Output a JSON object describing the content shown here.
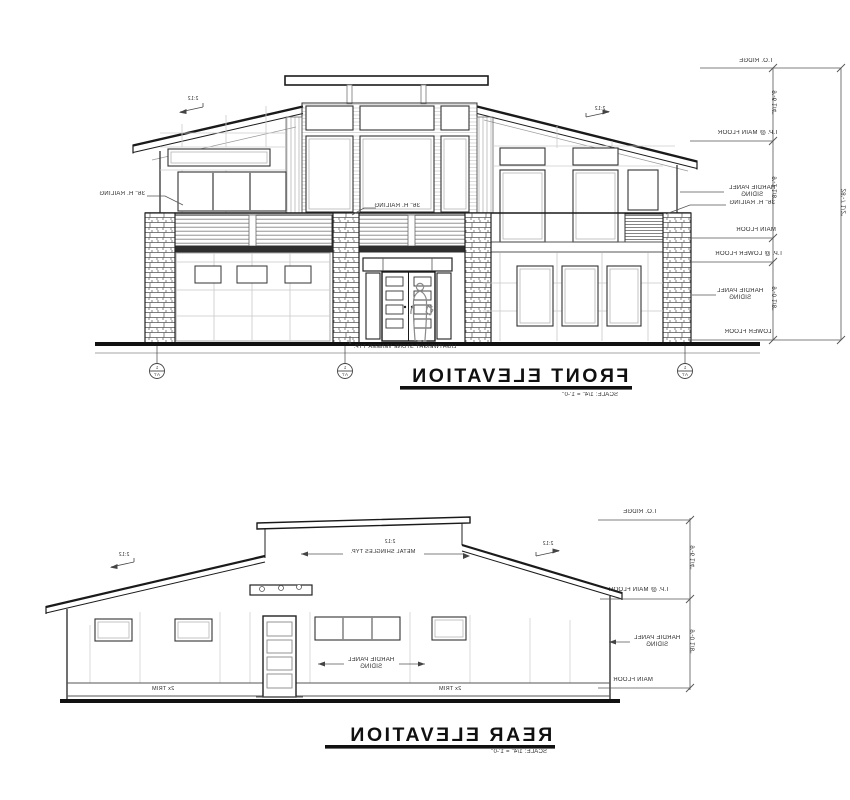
{
  "sheet": {
    "background": "#ffffff",
    "line_color": "#1a1a1a",
    "panel_gray": "#c9c9c9",
    "annotation_gray": "#555555"
  },
  "front": {
    "title": "FRONT ELEVATION",
    "scale_note": "SCALE: 1/4\" = 1'-0\"",
    "levels": {
      "ridge": "T.O. RIDGE",
      "plate_main": "T.P. @ MAIN FLOOR",
      "main": "MAIN FLOOR",
      "plate_lower": "T.P. @ LOWER FLOOR",
      "lower": "LOWER FLOOR"
    },
    "dims": {
      "ridge_to_plate": "9'-6 1/4\"",
      "plate_to_main": "9'-1 1/8\"",
      "plate_to_lower": "9'-0 1/8\"",
      "overall": "28'-7 1/2\""
    },
    "notes": {
      "hardie": "HARDIE PANEL\nSIDING",
      "railing": "36\" H. RAILING",
      "stone": "LIGHTWEIGHT STONE VENEER TYP.",
      "slope": "2:12"
    },
    "grid_bubble": {
      "top": "1",
      "bottom": "A7"
    }
  },
  "rear": {
    "title": "REAR ELEVATION",
    "scale_note": "SCALE: 1/4\" = 1'-0\"",
    "levels": {
      "ridge": "T.O. RIDGE",
      "plate_main": "T.P. @ MAIN FLOOR",
      "main": "MAIN FLOOR"
    },
    "dims": {
      "ridge_to_plate": "9'-6 1/4\"",
      "plate_to_main": "9'-0 1/8\""
    },
    "notes": {
      "shingles": "METAL SHINGLES TYP.",
      "slope": "2:12",
      "hardie": "HARDIE PANEL\nSIDING",
      "trim": "2x TRIM"
    }
  }
}
